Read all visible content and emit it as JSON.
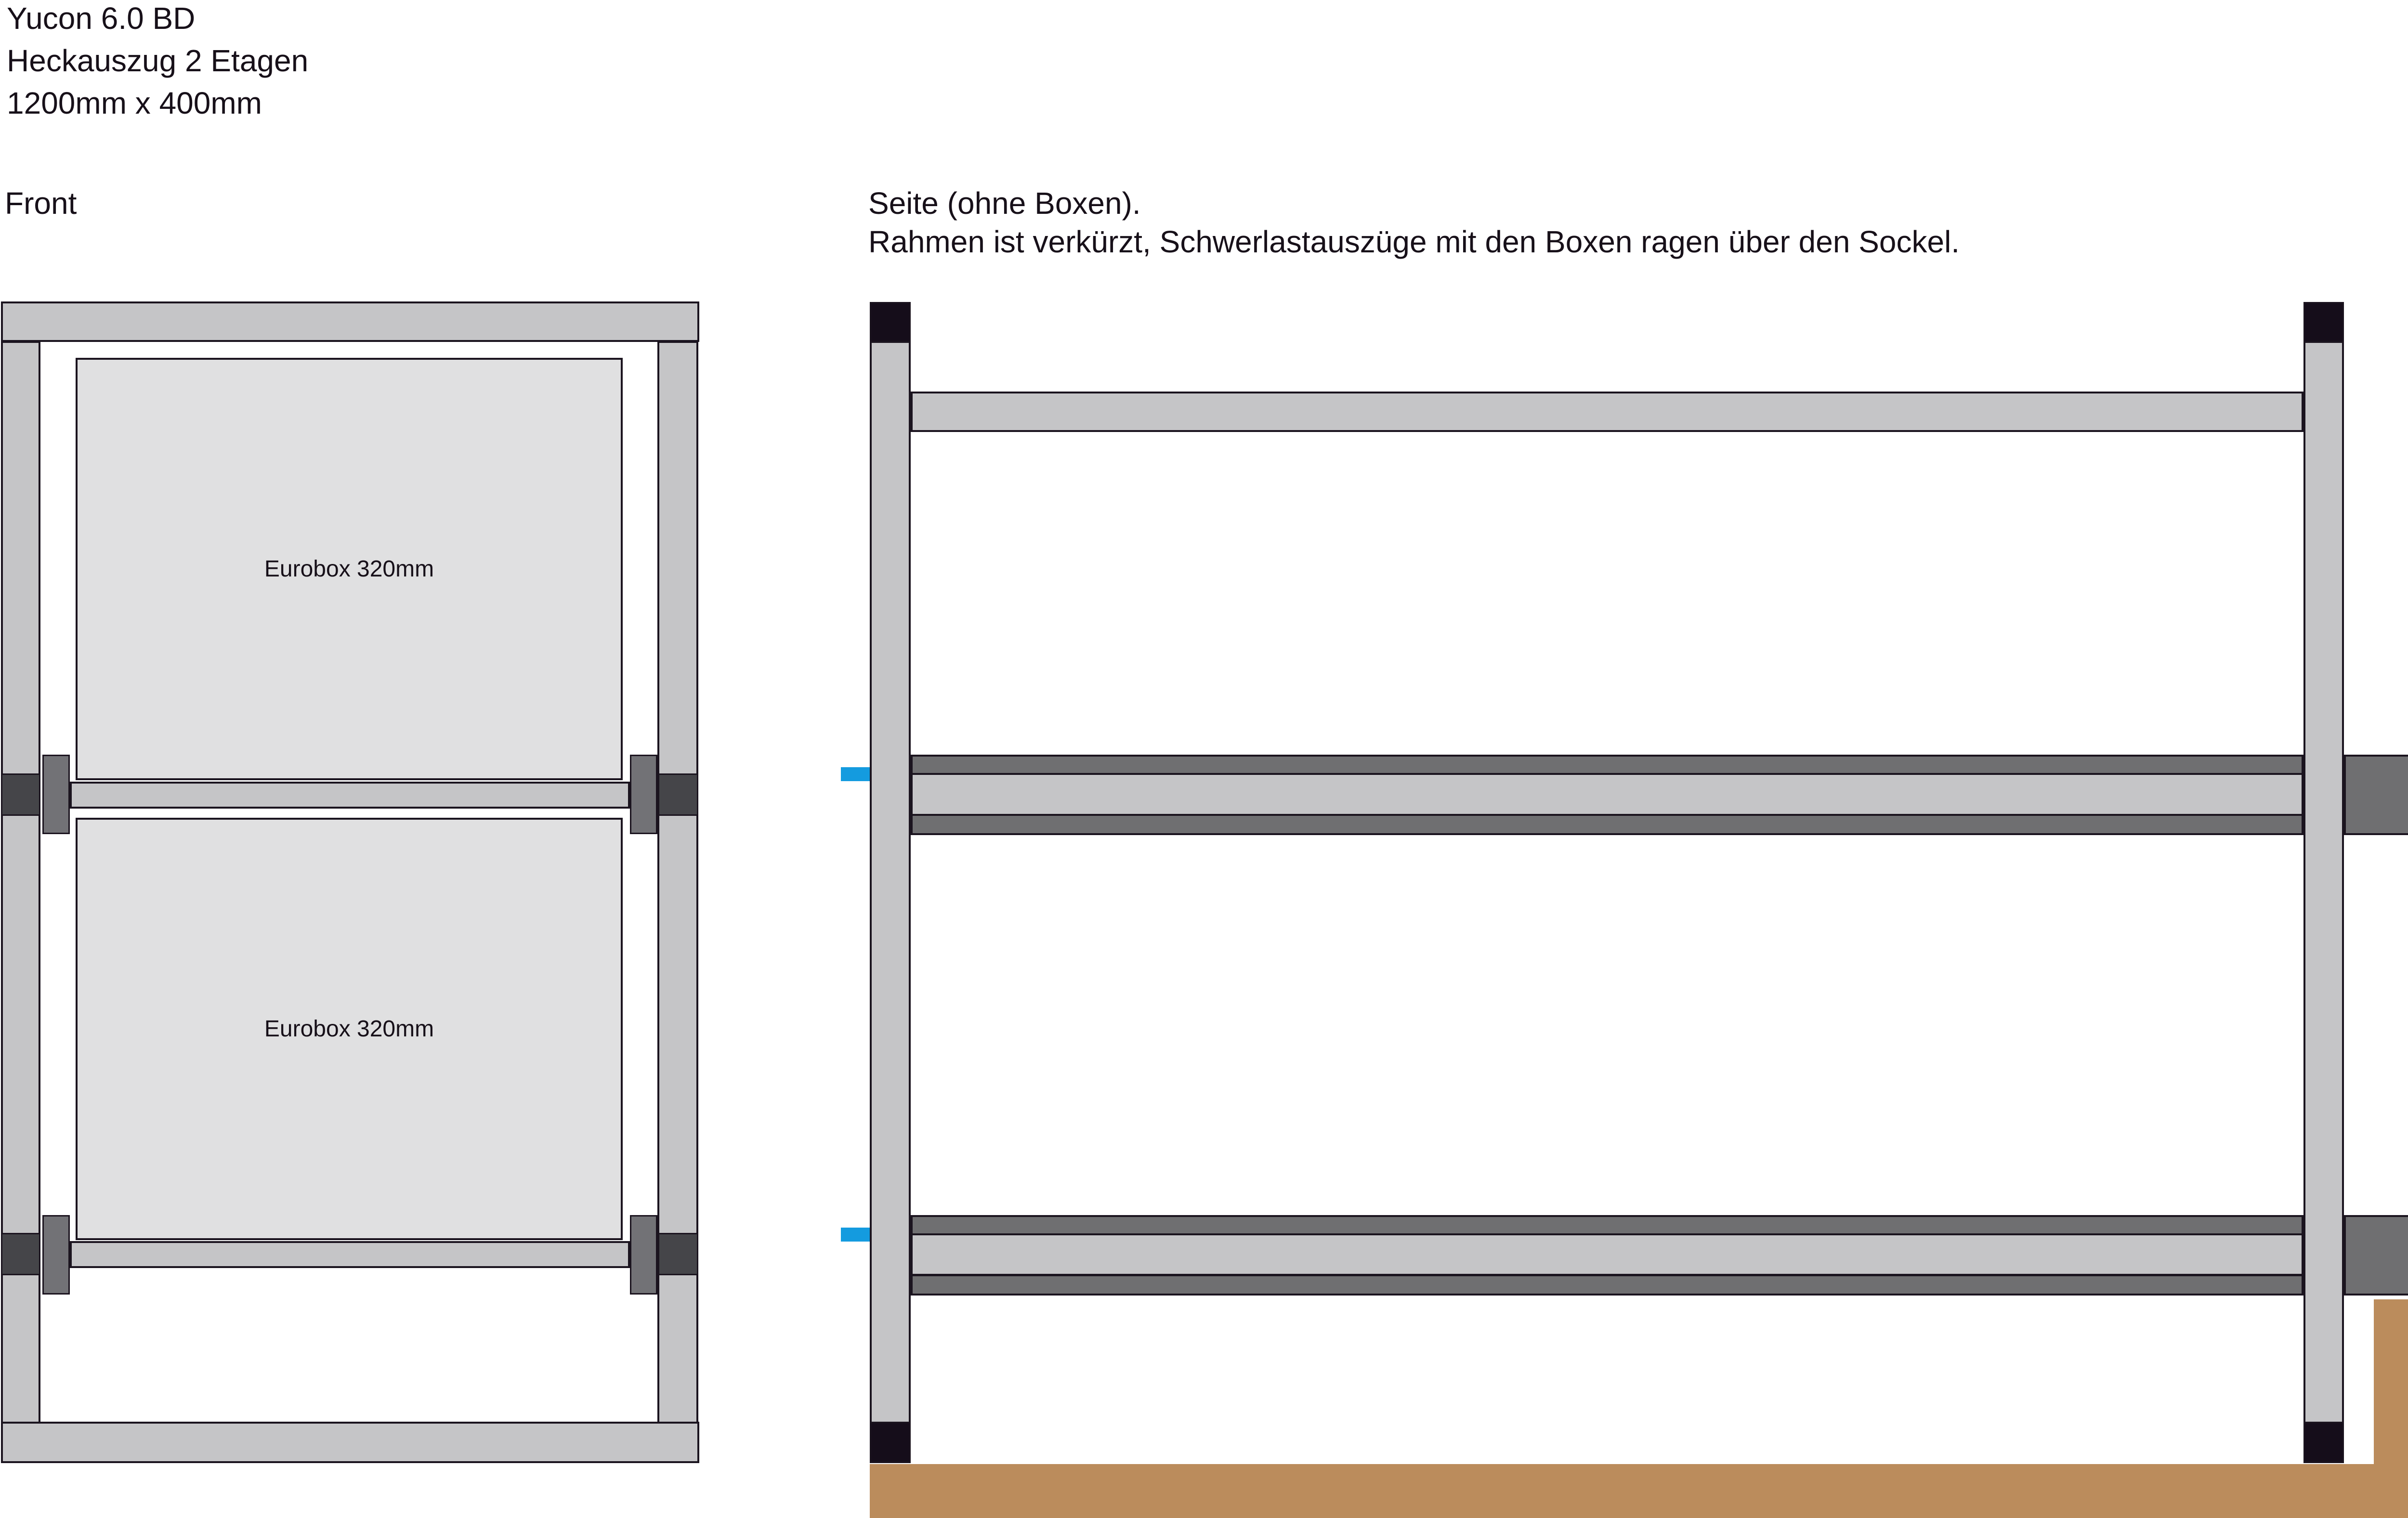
{
  "header": {
    "lines": [
      "Yucon 6.0 BD",
      "Heckauszug 2 Etagen",
      "1200mm x 400mm"
    ]
  },
  "front_view": {
    "label": "Front",
    "boxes": [
      {
        "label": "Eurobox 320mm"
      },
      {
        "label": "Eurobox 320mm"
      }
    ]
  },
  "side_view": {
    "label": "Seite (ohne Boxen).",
    "note": "Rahmen ist verkürzt, Schwerlastauszüge mit den Boxen ragen über den Sockel."
  },
  "colors": {
    "frame_light": "#c5c5c7",
    "frame_dark": "#6f6f71",
    "box_fill": "#e0e0e1",
    "connector_mid": "#727276",
    "connector_dark": "#454549",
    "cap_black": "#150d1a",
    "highlight_cyan": "#149bdf",
    "sockel_brown": "#bb8c5c",
    "outline": "#1b141f",
    "text": "#171019"
  }
}
